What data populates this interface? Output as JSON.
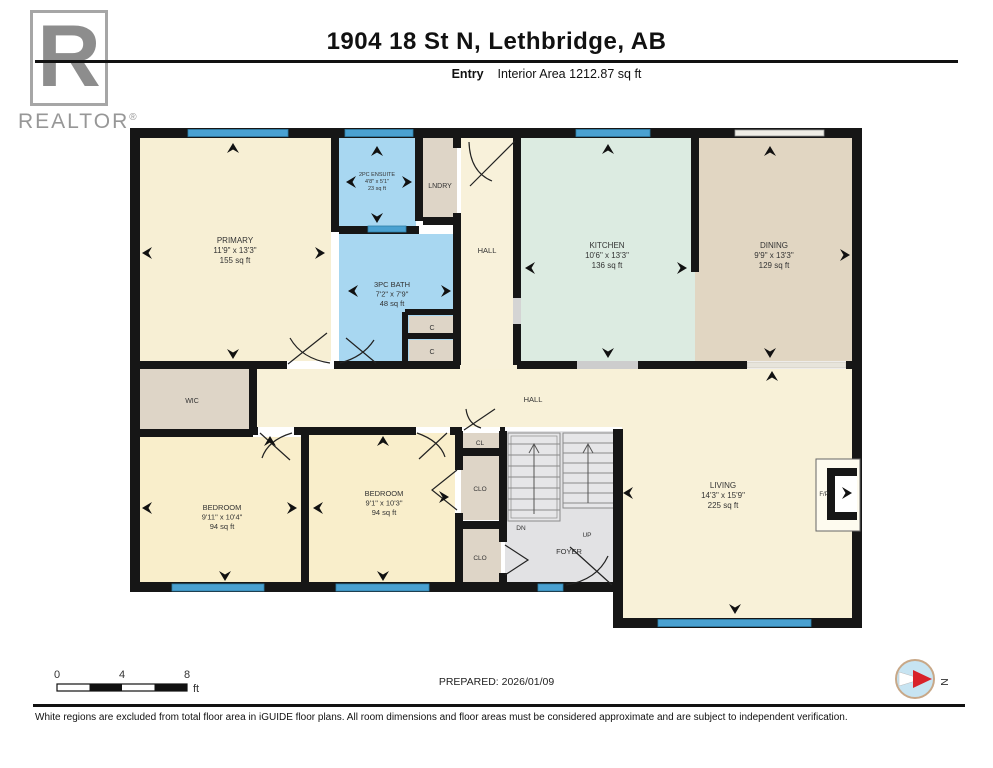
{
  "header": {
    "title": "1904 18 St N, Lethbridge, AB",
    "floor_label": "Entry",
    "area_label": "Interior Area 1212.87 sq ft"
  },
  "logo": {
    "letter": "R",
    "brand": "REALTOR",
    "registered": "®"
  },
  "colors": {
    "wall": "#161616",
    "window": "#4AA1D1",
    "cream": "#F7EFD4",
    "bedroom_cream": "#F9EECB",
    "bath_blue": "#A8D7F1",
    "kitchen_mint": "#DCEBE1",
    "dining_tan": "#E1D6C2",
    "closet_taupe": "#DED5C7",
    "stairs_gray": "#E2E2E4"
  },
  "floorplan": {
    "rooms": [
      {
        "id": "primary",
        "rect": [
          139,
          137,
          192,
          224
        ],
        "fill": "#F7EFD4",
        "cx": 235,
        "cy": 243,
        "fs": 8,
        "lines": [
          "PRIMARY",
          "11'9\" x 13'3\"",
          "155 sq ft"
        ]
      },
      {
        "id": "ensuite",
        "rect": [
          339,
          137,
          77,
          90
        ],
        "fill": "#A8D7F1",
        "cx": 377,
        "cy": 176,
        "fs": 5.5,
        "lines": [
          "2PC ENSUITE",
          "4'8\" x 5'1\"",
          "23 sq ft"
        ]
      },
      {
        "id": "laundry",
        "rect": [
          423,
          137,
          34,
          84
        ],
        "fill": "#DED5C7",
        "cx": 440,
        "cy": 188,
        "fs": 7,
        "lines": [
          "LNDRY"
        ]
      },
      {
        "id": "bath",
        "rect": [
          339,
          234,
          116,
          127
        ],
        "fill": "#A8D7F1",
        "cx": 392,
        "cy": 287,
        "fs": 7.5,
        "lines": [
          "3PC BATH",
          "7'2\" x 7'9\"",
          "48 sq ft"
        ]
      },
      {
        "id": "closet-c1",
        "rect": [
          409,
          316,
          46,
          18
        ],
        "fill": "#DED5C7",
        "cx": 432,
        "cy": 330,
        "fs": 7,
        "lines": [
          "C"
        ]
      },
      {
        "id": "closet-c2",
        "rect": [
          409,
          340,
          46,
          21
        ],
        "fill": "#DED5C7",
        "cx": 432,
        "cy": 354,
        "fs": 7,
        "lines": [
          "C"
        ]
      },
      {
        "id": "hall-entry",
        "rect": [
          461,
          137,
          52,
          228
        ],
        "fill": "#F8F1DA",
        "cx": 487,
        "cy": 253,
        "fs": 7.5,
        "lines": [
          "HALL"
        ]
      },
      {
        "id": "kitchen",
        "rect": [
          521,
          137,
          174,
          224
        ],
        "fill": "#DCEBE1",
        "cx": 607,
        "cy": 248,
        "fs": 8,
        "lines": [
          "KITCHEN",
          "10'6\" x 13'3\"",
          "136 sq ft"
        ]
      },
      {
        "id": "dining",
        "rect": [
          695,
          137,
          158,
          224
        ],
        "fill": "#E1D6C2",
        "cx": 774,
        "cy": 248,
        "fs": 8,
        "lines": [
          "DINING",
          "9'9\" x 13'3\"",
          "129 sq ft"
        ]
      },
      {
        "id": "hall-main",
        "rect": [
          257,
          369,
          596,
          58
        ],
        "fill": "#F8F1D8",
        "cx": 533,
        "cy": 402,
        "fs": 7.5,
        "lines": [
          "HALL"
        ]
      },
      {
        "id": "living",
        "rect": [
          622,
          369,
          231,
          250
        ],
        "fill": "#F8F1D8",
        "cx": 723,
        "cy": 488,
        "fs": 8,
        "lines": [
          "LIVING",
          "14'3\" x 15'9\"",
          "225 sq ft"
        ]
      },
      {
        "id": "wic",
        "rect": [
          139,
          369,
          110,
          60
        ],
        "fill": "#DED5C7",
        "cx": 192,
        "cy": 403,
        "fs": 7,
        "lines": [
          "WIC"
        ]
      },
      {
        "id": "bedroom-left",
        "rect": [
          139,
          437,
          162,
          146
        ],
        "fill": "#F9EECB",
        "cx": 222,
        "cy": 510,
        "fs": 7.5,
        "lines": [
          "BEDROOM",
          "9'11\" x 10'4\"",
          "94 sq ft"
        ]
      },
      {
        "id": "bedroom-right",
        "rect": [
          309,
          433,
          146,
          150
        ],
        "fill": "#F9EECB",
        "cx": 384,
        "cy": 496,
        "fs": 7.5,
        "lines": [
          "BEDROOM",
          "9'1\" x 10'3\"",
          "94 sq ft"
        ]
      },
      {
        "id": "closet-cl",
        "rect": [
          461,
          433,
          40,
          17
        ],
        "fill": "#DED5C7",
        "cx": 480,
        "cy": 445,
        "fs": 6.5,
        "lines": [
          "CL"
        ]
      },
      {
        "id": "closet-clo1",
        "rect": [
          461,
          454,
          40,
          66
        ],
        "fill": "#DED5C7",
        "cx": 480,
        "cy": 491,
        "fs": 6.5,
        "lines": [
          "CLO"
        ]
      },
      {
        "id": "closet-clo2",
        "rect": [
          461,
          529,
          40,
          54
        ],
        "fill": "#DED5C7",
        "cx": 480,
        "cy": 560,
        "fs": 6.5,
        "lines": [
          "CLO"
        ]
      },
      {
        "id": "stairs-foyer",
        "rect": [
          505,
          431,
          111,
          152
        ],
        "fill": "#E2E2E4",
        "cx": 0,
        "cy": 0,
        "fs": 0,
        "lines": []
      },
      {
        "id": "stairs-dn",
        "rect": null,
        "cx": 521,
        "cy": 530,
        "fs": 6.5,
        "lines": [
          "DN"
        ]
      },
      {
        "id": "stairs-up",
        "rect": null,
        "cx": 587,
        "cy": 537,
        "fs": 6.5,
        "lines": [
          "UP"
        ]
      },
      {
        "id": "foyer",
        "rect": null,
        "cx": 569,
        "cy": 554,
        "fs": 7.5,
        "lines": [
          "FOYER"
        ]
      },
      {
        "id": "fireplace",
        "rect": null,
        "cx": 824,
        "cy": 496,
        "fs": 6,
        "lines": [
          "F/P"
        ]
      }
    ]
  },
  "footer": {
    "scale": {
      "start": "0",
      "mid": "4",
      "end": "8",
      "unit": "ft"
    },
    "prepared": "PREPARED: 2026/01/09",
    "north": "N",
    "disclaimer": "White regions are excluded from total floor area in iGUIDE floor plans. All room dimensions and floor areas must be considered approximate and are subject to independent verification."
  }
}
